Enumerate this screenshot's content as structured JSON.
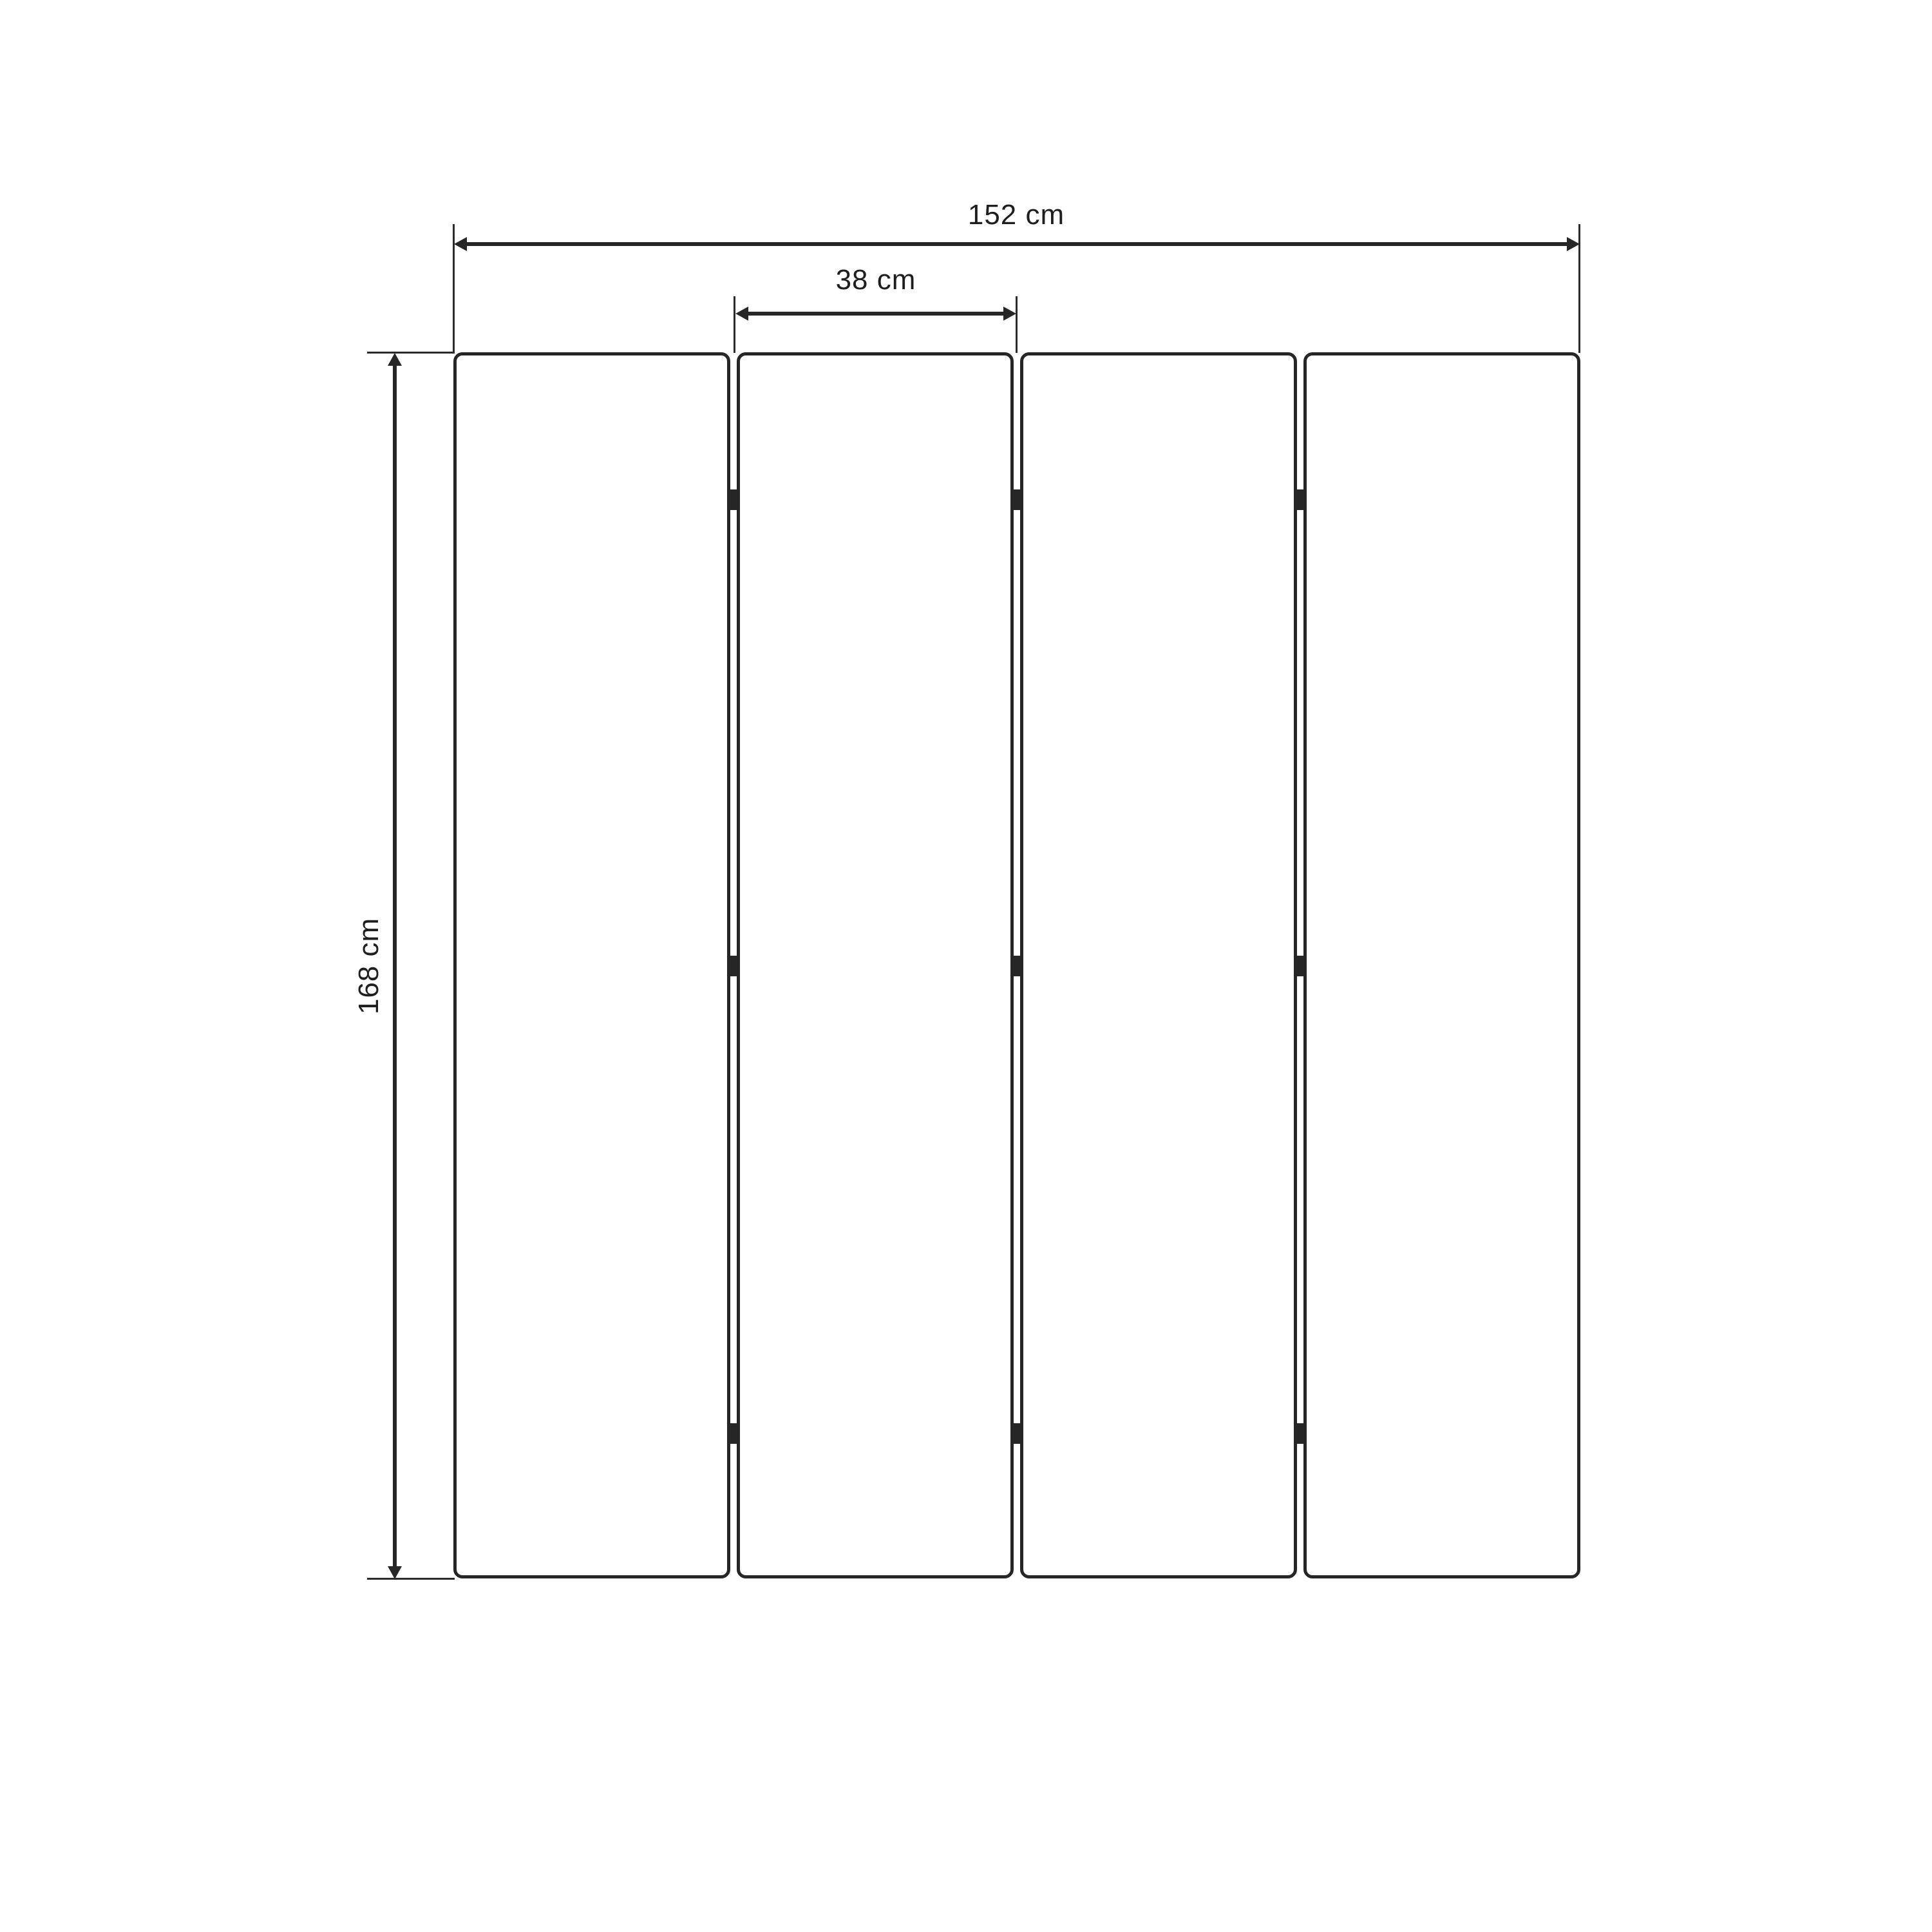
{
  "diagram": {
    "description": "Front-view dimension diagram of a four-panel folding screen; each gap between panels has three hinge marks",
    "dimensions": {
      "total_width": {
        "label": "152 cm",
        "value": 152,
        "unit": "cm"
      },
      "panel_width": {
        "label": "38 cm",
        "value": 38,
        "unit": "cm"
      },
      "height": {
        "label": "168 cm",
        "value": 168,
        "unit": "cm"
      }
    },
    "panels": {
      "count": 4,
      "gaps": 3,
      "hinges_per_gap": 3
    },
    "colors": {
      "line": "#262626",
      "text": "#1e1e1e",
      "background": "#ffffff"
    }
  }
}
